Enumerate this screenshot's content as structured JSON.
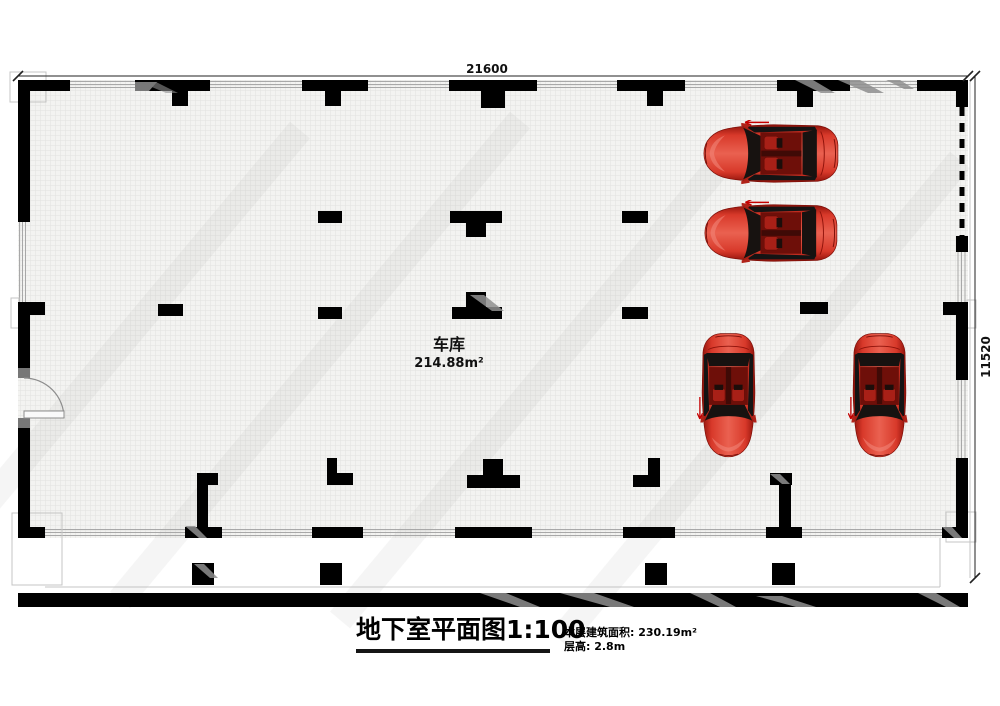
{
  "plan": {
    "top_dimension": "21600",
    "side_dimension": "11520",
    "room": {
      "label": "车库",
      "area": "214.88m²"
    }
  },
  "title_block": {
    "title": "地下室平面图1:100",
    "area_line": "本层建筑面积: 230.19m²",
    "height_line": "层高: 2.8m"
  },
  "cars": {
    "count": 4,
    "body_color": "#c8241c"
  },
  "colors": {
    "wall": "#000000",
    "floor_line": "#e2e2e0",
    "dimension_text": "#111111"
  }
}
